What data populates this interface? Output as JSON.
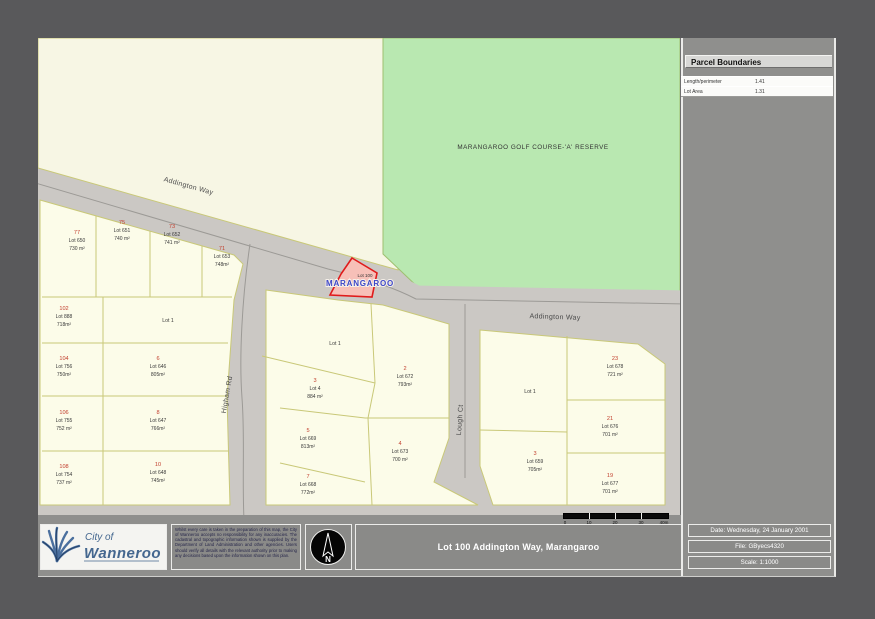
{
  "colors": {
    "outer_bg": "#59595b",
    "sheet_bg": "#8f8f8d",
    "map_base": "#f7f6e4",
    "parcel_fill": "#fcfce9",
    "parcel_line": "#c9c878",
    "road_fill": "#cbc8c4",
    "road_centerline": "#9c9a96",
    "golf_fill": "#b9e8b1",
    "highlight_fill": "#f7c0b8",
    "highlight_stroke": "#e01b1b",
    "house_number": "#c2402f",
    "lot_text": "#3a3a3a",
    "suburb_blue": "#3c46c8"
  },
  "legend": {
    "title": "Parcel Boundaries",
    "rows": [
      {
        "label": "Length/perimeter",
        "value": "1.41"
      },
      {
        "label": "Lot Area",
        "value": "1.31"
      }
    ]
  },
  "map": {
    "golf_label": "MARANGAROO GOLF COURSE-'A' RESERVE",
    "suburb_label": "MARANGAROO",
    "highlight_lot_label": "Lot 100",
    "streets": [
      {
        "name": "Addington Way",
        "x": 150,
        "y": 150,
        "rot": 15.5
      },
      {
        "name": "Addington Way",
        "x": 517,
        "y": 281,
        "rot": 2
      },
      {
        "name": "Higham Rd",
        "x": 191,
        "y": 357,
        "rot": -80
      },
      {
        "name": "Lough Ct",
        "x": 424,
        "y": 382,
        "rot": -86
      }
    ],
    "named_lots": [
      {
        "label": "Lot 1",
        "x": 130,
        "y": 284
      },
      {
        "label": "Lot 1",
        "x": 297,
        "y": 307
      },
      {
        "label": "Lot 1",
        "x": 492,
        "y": 355
      }
    ],
    "lots": [
      {
        "house": "77",
        "lot": "Lot 650",
        "area": "730 m²",
        "x": 39,
        "y": 196
      },
      {
        "house": "75",
        "lot": "Lot 651",
        "area": "740 m²",
        "x": 84,
        "y": 186
      },
      {
        "house": "73",
        "lot": "Lot 652",
        "area": "741 m²",
        "x": 134,
        "y": 190
      },
      {
        "house": "71",
        "lot": "Lot 653",
        "area": "748m²",
        "x": 184,
        "y": 212
      },
      {
        "house": "102",
        "lot": "Lot 888",
        "area": "718m²",
        "x": 26,
        "y": 272
      },
      {
        "house": "104",
        "lot": "Lot 756",
        "area": "750m²",
        "x": 26,
        "y": 322
      },
      {
        "house": "106",
        "lot": "Lot 755",
        "area": "752 m²",
        "x": 26,
        "y": 376
      },
      {
        "house": "108",
        "lot": "Lot 754",
        "area": "737 m²",
        "x": 26,
        "y": 430
      },
      {
        "house": "6",
        "lot": "Lot 646",
        "area": "805m²",
        "x": 120,
        "y": 322
      },
      {
        "house": "8",
        "lot": "Lot 647",
        "area": "766m²",
        "x": 120,
        "y": 376
      },
      {
        "house": "10",
        "lot": "Lot 648",
        "area": "745m²",
        "x": 120,
        "y": 428
      },
      {
        "house": "3",
        "lot": "Lot 4",
        "area": "884 m²",
        "x": 277,
        "y": 344
      },
      {
        "house": "5",
        "lot": "Lot 669",
        "area": "813m²",
        "x": 270,
        "y": 394
      },
      {
        "house": "7",
        "lot": "Lot 668",
        "area": "772m²",
        "x": 270,
        "y": 440
      },
      {
        "house": "2",
        "lot": "Lot 672",
        "area": "793m²",
        "x": 367,
        "y": 332
      },
      {
        "house": "4",
        "lot": "Lot 673",
        "area": "700 m²",
        "x": 362,
        "y": 407
      },
      {
        "house": "3",
        "lot": "Lot 659",
        "area": "705m²",
        "x": 497,
        "y": 417
      },
      {
        "house": "23",
        "lot": "Lot 678",
        "area": "721 m²",
        "x": 577,
        "y": 322
      },
      {
        "house": "21",
        "lot": "Lot 676",
        "area": "701 m²",
        "x": 572,
        "y": 382
      },
      {
        "house": "19",
        "lot": "Lot 677",
        "area": "701 m²",
        "x": 572,
        "y": 439
      }
    ]
  },
  "scalebar": {
    "labels": [
      "0",
      "10",
      "20",
      "30",
      "40m"
    ]
  },
  "footer": {
    "logo_line1": "City of",
    "logo_line2": "Wanneroo",
    "disclaimer": "Whilst every care is taken in the preparation of this map, the City of Wanneroo accepts no responsibility for any inaccuracies. The cadastral and topographic information shown is supplied by the Department of Land Administration and other agencies. Users should verify all details with the relevant authority prior to making any decisions based upon the information shown on this plan.",
    "north_label": "N",
    "title": "Lot 100 Addington Way, Marangaroo",
    "info_rows": [
      "Date: Wednesday, 24 January 2001",
      "File: GByecs4320",
      "Scale: 1:1000"
    ]
  }
}
